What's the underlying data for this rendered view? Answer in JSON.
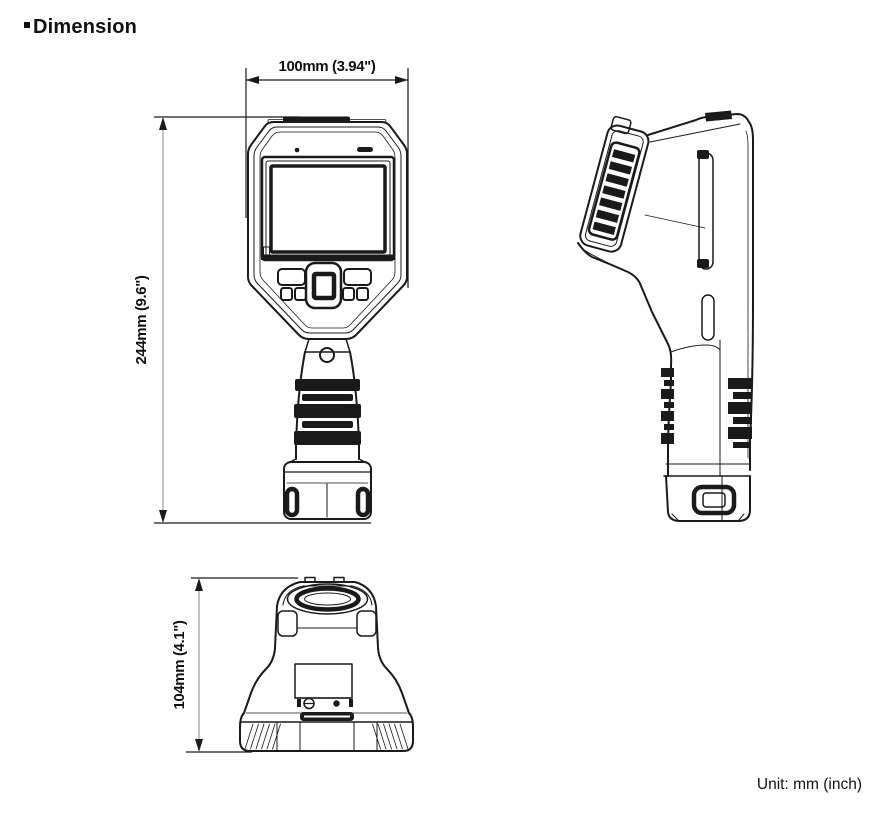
{
  "header": {
    "title": "Dimension"
  },
  "footer": {
    "unit_note": "Unit: mm (inch)"
  },
  "dimensions": {
    "width_label": "100mm (3.94\")",
    "height_label": "244mm (9.6\")",
    "depth_label": "104mm (4.1\")"
  },
  "colors": {
    "line": "#1a1a1a",
    "dimension_line": "#8a8a8a",
    "text": "#111111",
    "background": "#ffffff"
  }
}
